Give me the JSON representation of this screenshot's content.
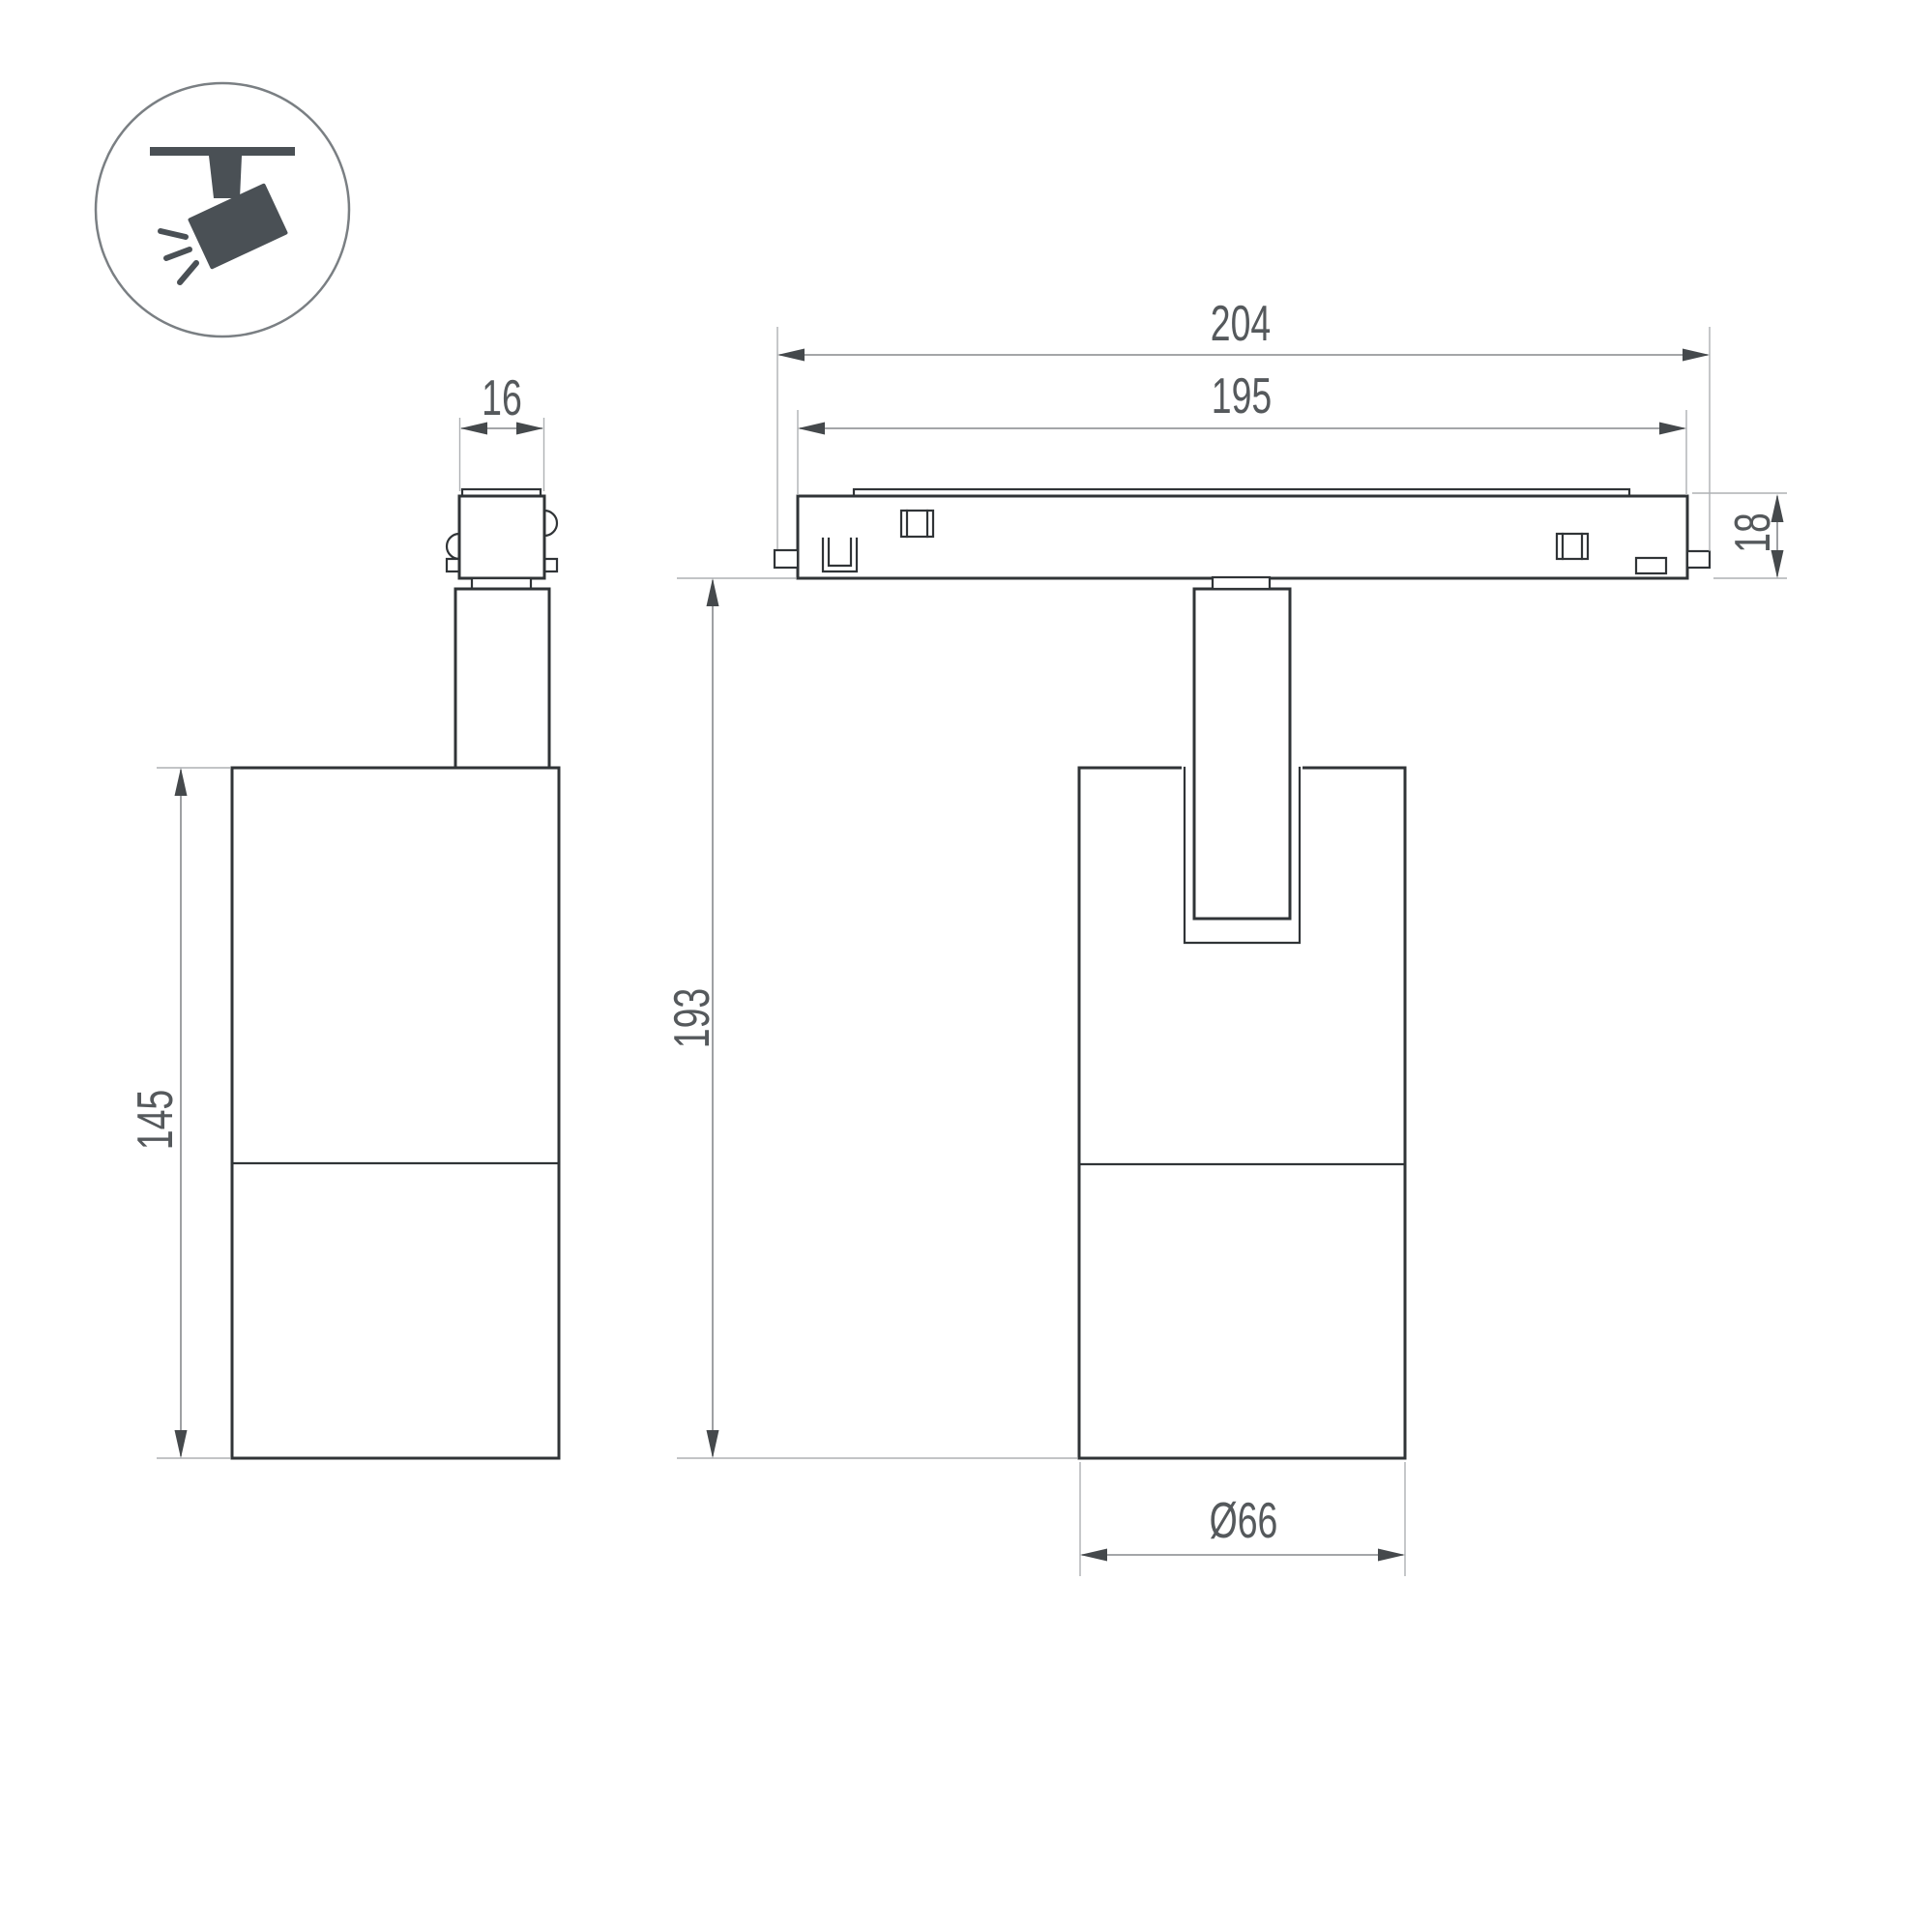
{
  "drawing": {
    "icon": {
      "name": "ceiling-track-spotlight-icon"
    },
    "dimensions": {
      "adapter_width": "16",
      "body_length": "145",
      "track_total_length": "204",
      "track_rail_length": "195",
      "track_height": "18",
      "overall_height": "193",
      "body_diameter": "Ø66"
    },
    "colors": {
      "outline": "#303437",
      "dimension_line": "#85898c",
      "extension_line": "#aeb1b4",
      "arrow": "#45494c",
      "text": "#55595c",
      "icon": "#4a5055",
      "background": "#ffffff"
    }
  }
}
